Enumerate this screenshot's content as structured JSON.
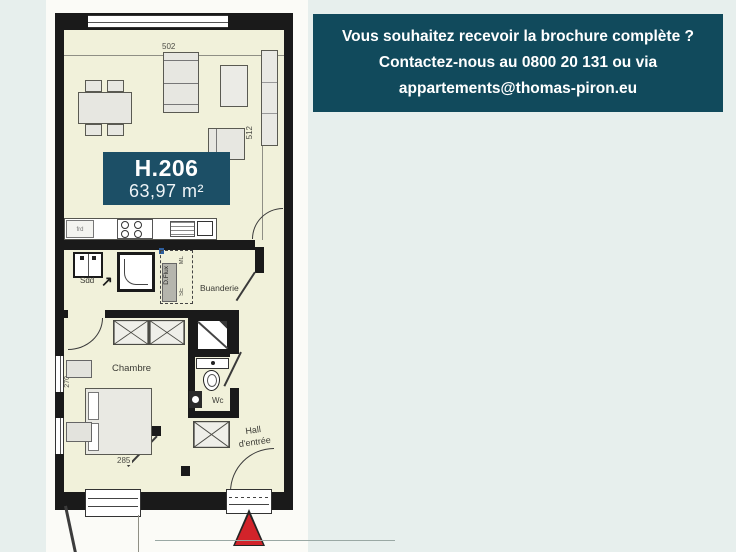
{
  "page": {
    "background": "#e7efed",
    "paper": "#fbfbf7"
  },
  "banner": {
    "background": "#114a5c",
    "text_color": "#ffffff",
    "lines": [
      "Vous souhaitez recevoir la brochure complète ?",
      "Contactez-nous au 0800 20 131 ou via",
      "appartements@thomas-piron.eu"
    ]
  },
  "floorplan": {
    "unit": {
      "number": "H.206",
      "area": "63,97 m²",
      "badge_background": "#1c4f66"
    },
    "room_labels": {
      "sdd": "Sdd",
      "buanderie": "Buanderie",
      "chambre": "Chambre",
      "wc": "Wc",
      "hall_line1": "Hall",
      "hall_line2": "d'entrée"
    },
    "dimensions": {
      "living_width": "502",
      "living_depth": "512",
      "bed_width": "285",
      "bed_depth": "270"
    },
    "equipment_labels": {
      "fridge": "frd",
      "ventilation": "D.Flux",
      "washing_machine": "ML",
      "dryer": "SE"
    },
    "icons": {
      "direction_arrow": "↗"
    },
    "colors": {
      "walls": "#1a1a1a",
      "room_fill": "#f1f1da",
      "entrance_marker": "#d2232a"
    }
  }
}
